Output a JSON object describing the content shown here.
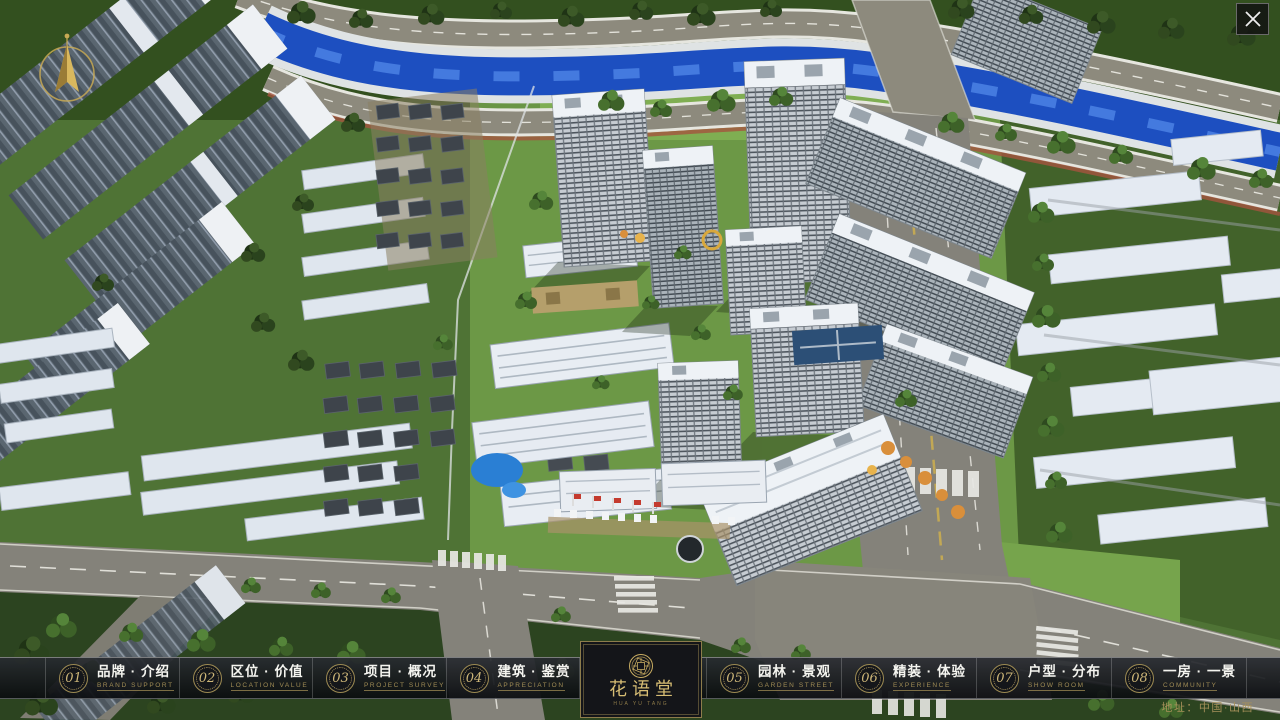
{
  "ui": {
    "nav": {
      "items": [
        {
          "num": "01",
          "zh": "品牌 · 介绍",
          "en": "BRAND SUPPORT"
        },
        {
          "num": "02",
          "zh": "区位 · 价值",
          "en": "LOCATION VALUE"
        },
        {
          "num": "03",
          "zh": "项目 · 概况",
          "en": "PROJECT SURVEY"
        },
        {
          "num": "04",
          "zh": "建筑 · 鉴赏",
          "en": "APPRECIATION"
        },
        {
          "num": "05",
          "zh": "园林 · 景观",
          "en": "GARDEN STREET"
        },
        {
          "num": "06",
          "zh": "精装 · 体验",
          "en": "EXPERIENCE"
        },
        {
          "num": "07",
          "zh": "户型 · 分布",
          "en": "SHOW ROOM"
        },
        {
          "num": "08",
          "zh": "一房 · 一景",
          "en": "COMMUNITY"
        }
      ]
    },
    "logo": {
      "title": "花语堂",
      "subtitle": "HUA YU TANG"
    },
    "address": "地址：中国·山西"
  },
  "colors": {
    "gold_accent": "#c9ad62",
    "nav_text": "#f4f4ef",
    "nav_sub": "#a08c55",
    "river": "#1d4fc0",
    "bar_bg": "#14161a"
  },
  "scene": {
    "description": "Aerial 3D masterplan render of residential community",
    "features": [
      "river",
      "ring-roads",
      "highrise-towers",
      "courtyard-villas",
      "white-row-housing",
      "entrance-gate",
      "pool",
      "compass-north"
    ]
  }
}
